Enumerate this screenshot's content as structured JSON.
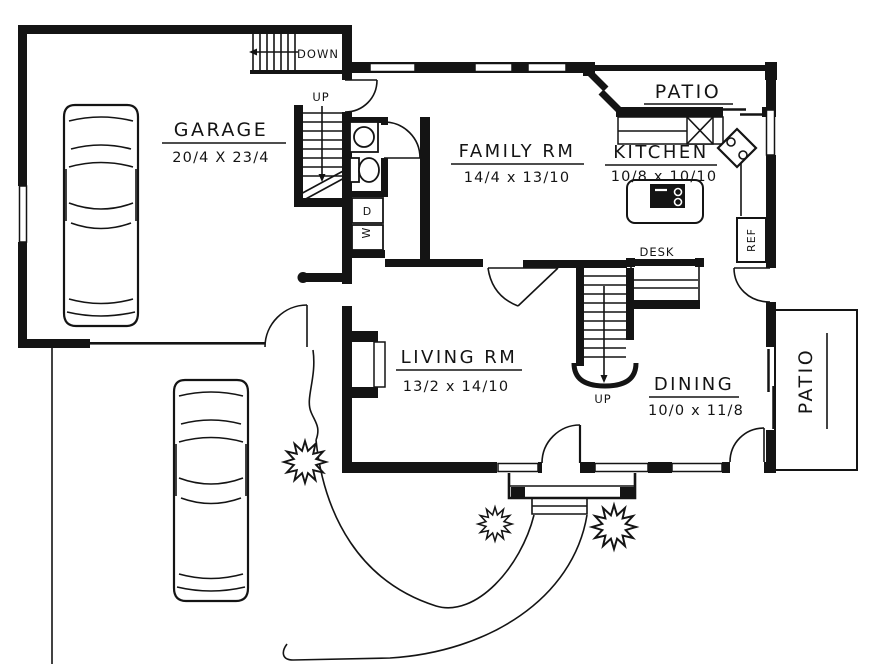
{
  "colors": {
    "ink": "#141414",
    "paper": "#ffffff"
  },
  "rooms": {
    "garage": {
      "label": "GARAGE",
      "dims": "20/4 X 23/4"
    },
    "family_room": {
      "label": "FAMILY RM",
      "dims": "14/4 x 13/10"
    },
    "kitchen": {
      "label": "KITCHEN",
      "dims": "10/8 x 10/10"
    },
    "living_room": {
      "label": "LIVING RM",
      "dims": "13/2 x 14/10"
    },
    "dining_room": {
      "label": "DINING",
      "dims": "10/0 x 11/8"
    },
    "patio_upper": {
      "label": "PATIO"
    },
    "patio_side": {
      "label": "PATIO"
    }
  },
  "annotations": {
    "desk": "DESK",
    "refrigerator": "REF",
    "stairs_down": "DOWN",
    "stairs_up_garage": "UP",
    "stairs_up_main": "UP",
    "dryer": "D",
    "washer": "W"
  }
}
